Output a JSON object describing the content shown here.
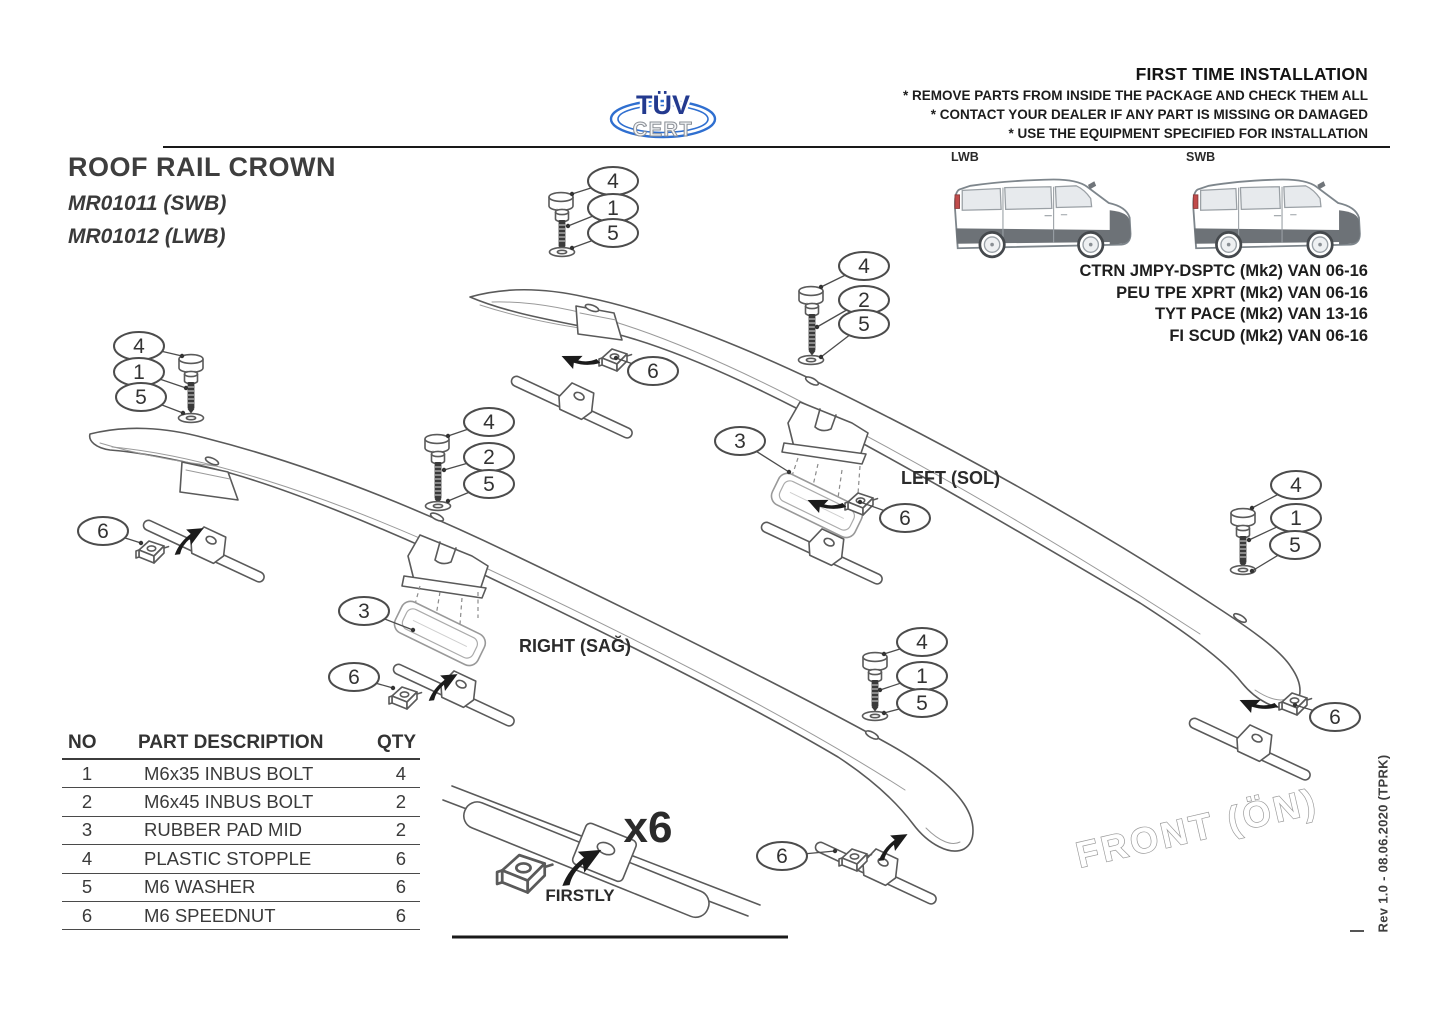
{
  "header": {
    "title": "FIRST TIME INSTALLATION",
    "notes": [
      "* REMOVE PARTS FROM INSIDE THE PACKAGE AND CHECK THEM ALL",
      "* CONTACT YOUR DEALER IF ANY PART IS MISSING OR DAMAGED",
      "* USE THE EQUIPMENT SPECIFIED FOR INSTALLATION"
    ]
  },
  "logo": {
    "top": "TÜV",
    "bottom": "CERT"
  },
  "product": {
    "title": "ROOF RAIL CROWN",
    "code_swb": "MR01011 (SWB)",
    "code_lwb": "MR01012 (LWB)"
  },
  "vans": {
    "lwb": "LWB",
    "swb": "SWB"
  },
  "compatibility": [
    "CTRN JMPY-DSPTC (Mk2) VAN 06-16",
    "PEU TPE XPRT (Mk2) VAN 06-16",
    "TYT PACE (Mk2) VAN 13-16",
    "FI SCUD (Mk2) VAN 06-16"
  ],
  "table": {
    "headers": {
      "no": "NO",
      "desc": "PART DESCRIPTION",
      "qty": "QTY"
    }
  },
  "parts": [
    {
      "no": "1",
      "desc": "M6x35 INBUS BOLT",
      "qty": "4"
    },
    {
      "no": "2",
      "desc": "M6x45 INBUS BOLT",
      "qty": "2"
    },
    {
      "no": "3",
      "desc": "RUBBER PAD MID",
      "qty": "2"
    },
    {
      "no": "4",
      "desc": "PLASTIC STOPPLE",
      "qty": "6"
    },
    {
      "no": "5",
      "desc": "M6 WASHER",
      "qty": "6"
    },
    {
      "no": "6",
      "desc": "M6 SPEEDNUT",
      "qty": "6"
    }
  ],
  "diagram": {
    "left_label": "LEFT (SOL)",
    "right_label": "RIGHT (SAĞ)",
    "detail_qty": "x6",
    "detail_step": "FIRSTLY",
    "front_label": "FRONT (ÖN)"
  },
  "revision": "Rev 1.0 - 08.06.2020 (TPRK)"
}
